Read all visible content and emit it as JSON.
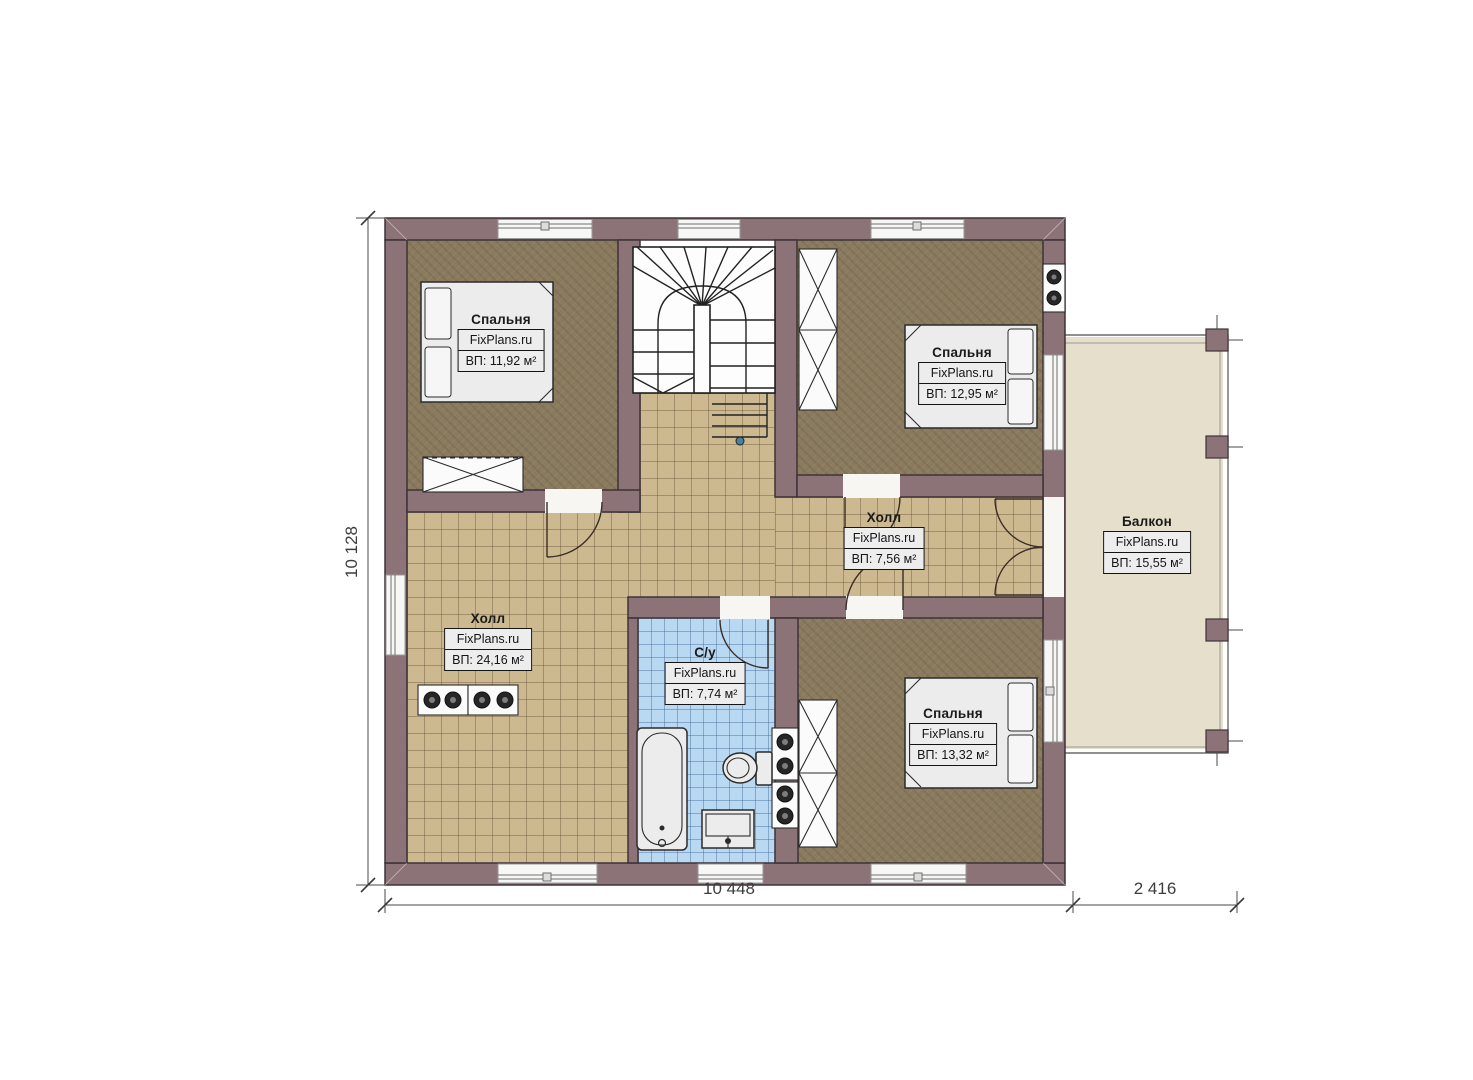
{
  "meta": {
    "type": "floor-plan",
    "branding": "FixPlans.ru"
  },
  "colors": {
    "wall": "#8C7377",
    "wall_outline": "#3E3339",
    "bedroom_floor": "#8A7A5E",
    "hall_tile": "#CDB990",
    "bathroom_tile": "#B9D8F2",
    "balcony_floor": "#E6DFCB",
    "label_box_bg": "#EDEDED",
    "line": "#2B2B2B"
  },
  "rooms": [
    {
      "id": "bedroom-top-left",
      "name": "Спальня",
      "brand": "FixPlans.ru",
      "area": "ВП: 11,92 м²"
    },
    {
      "id": "bedroom-top-right",
      "name": "Спальня",
      "brand": "FixPlans.ru",
      "area": "ВП: 12,95 м²"
    },
    {
      "id": "hall-middle",
      "name": "Холл",
      "brand": "FixPlans.ru",
      "area": "ВП: 7,56 м²"
    },
    {
      "id": "hall-left",
      "name": "Холл",
      "brand": "FixPlans.ru",
      "area": "ВП: 24,16 м²"
    },
    {
      "id": "bathroom",
      "name": "С/у",
      "brand": "FixPlans.ru",
      "area": "ВП: 7,74 м²"
    },
    {
      "id": "bedroom-bottom",
      "name": "Спальня",
      "brand": "FixPlans.ru",
      "area": "ВП: 13,32 м²"
    },
    {
      "id": "balcony",
      "name": "Балкон",
      "brand": "FixPlans.ru",
      "area": "ВП: 15,55 м²"
    }
  ],
  "dimensions": {
    "left": "10 128",
    "bottom_main": "10 448",
    "bottom_balcony": "2 416"
  }
}
